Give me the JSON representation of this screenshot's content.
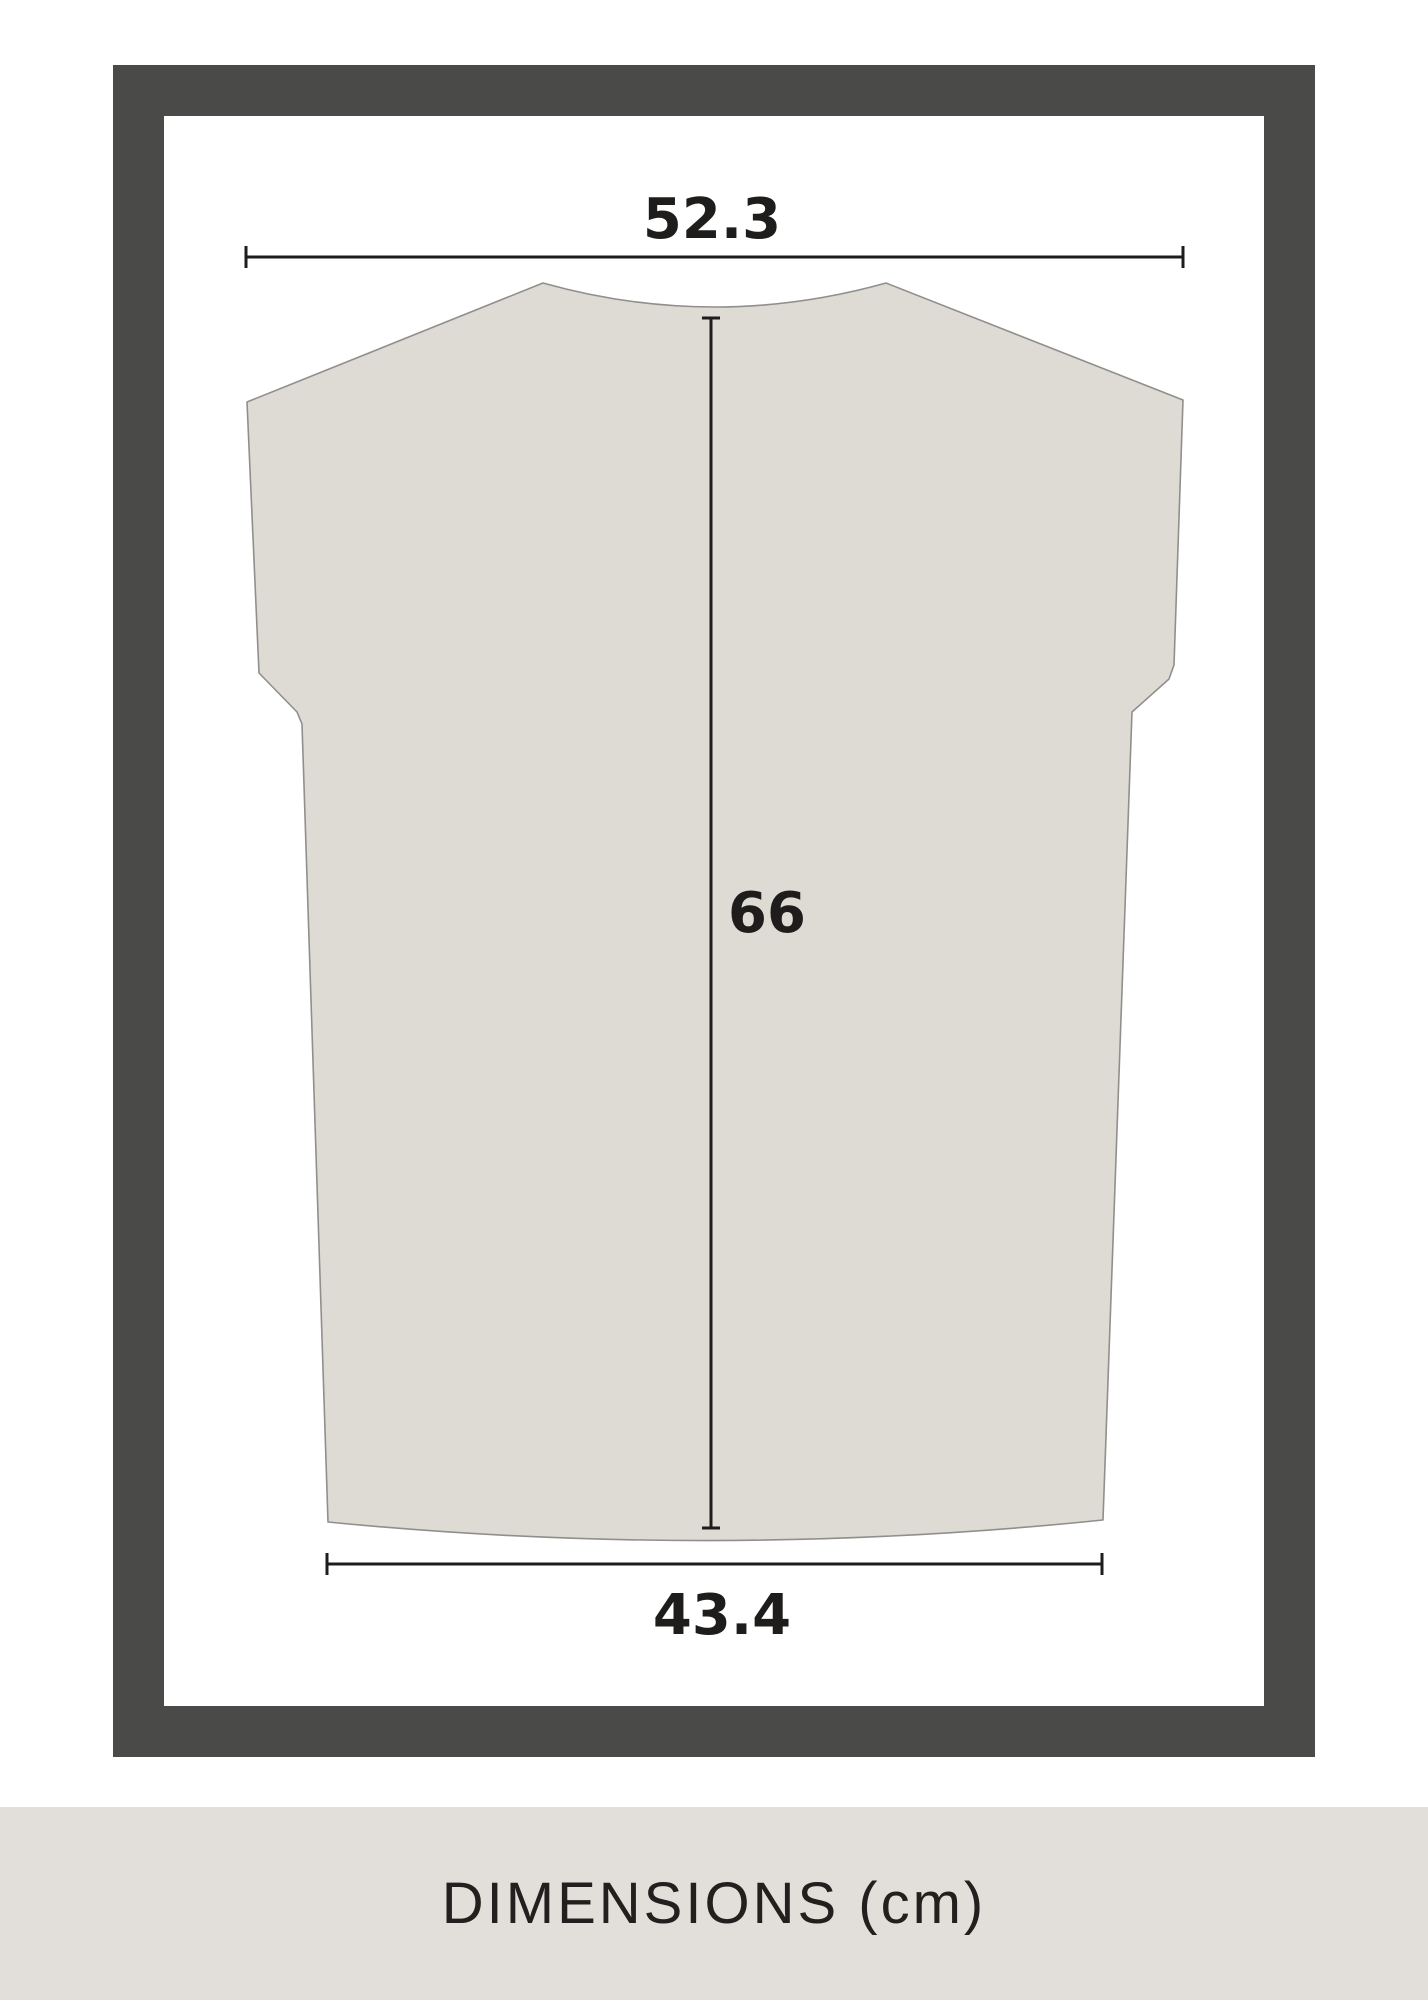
{
  "measurements": {
    "unit": "cm",
    "top_width": {
      "value": 52.3,
      "label": "52.3"
    },
    "length": {
      "value": 66,
      "label": "66"
    },
    "bottom_width": {
      "value": 43.4,
      "label": "43.4"
    }
  },
  "footer": {
    "caption": "DIMENSIONS (cm)"
  },
  "colors": {
    "bg": "#ffffff",
    "frame": "#4a4a49",
    "garment-fill": "#dedbd5",
    "garment-stroke": "#918f8b",
    "dim": "#1e1d1b",
    "footer-bg": "#e2dfda",
    "footer-text": "#22201e"
  }
}
